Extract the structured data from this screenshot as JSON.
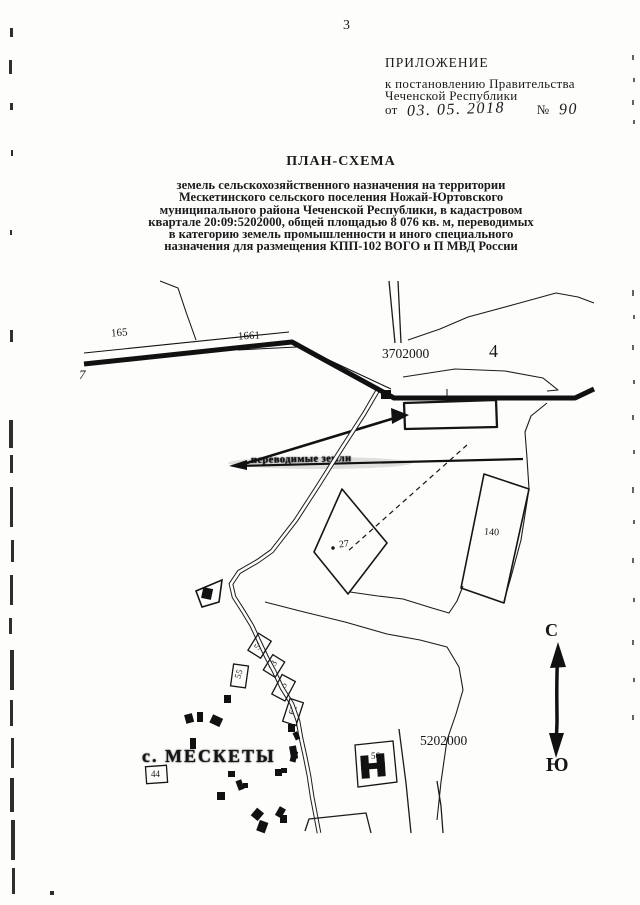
{
  "page": {
    "number": "3"
  },
  "header": {
    "appendix_title": "ПРИЛОЖЕНИЕ",
    "appendix_line1": "к постановлению Правительства",
    "appendix_line2": "Чеченской Республики",
    "date_prefix": "от",
    "date_value": "03. 05. 2018",
    "number_sign": "№",
    "number_value": "90"
  },
  "title_block": {
    "title": "ПЛАН-СХЕМА",
    "subtitle_lines": [
      "земель сельскохозяйственного назначения на территории",
      "Мескетинского сельского поселения Ножай-Юртовского",
      "муниципального района Чеченской Республики, в кадастровом",
      "квартале 20:09:5202000, общей площадью 8 076 кв. м, переводимых",
      "в категорию земель промышленности и иного специального",
      "назначения для размещения КПП-102 ВОГО и П МВД России"
    ]
  },
  "map": {
    "labels": {
      "road_marker_left": "165",
      "road_marker_right": "1661",
      "road_marker_far_left": "7",
      "grid_x": "3702000",
      "grid_y": "5202000",
      "quarter": "4",
      "transfer_label": "переводимые земли",
      "parcel_27": "27",
      "parcel_140": "140",
      "village_name": "с. МЕСКЕТЫ",
      "plot_44": "44",
      "plot_55": "55",
      "plot_56": "56",
      "plot_59": "59",
      "plot_63": "63",
      "plot_45": "45",
      "plot_62": "62",
      "compass_north": "С",
      "compass_south": "Ю"
    },
    "colors": {
      "ink": "#1b1b1b",
      "paper": "#fdfdfc"
    }
  }
}
